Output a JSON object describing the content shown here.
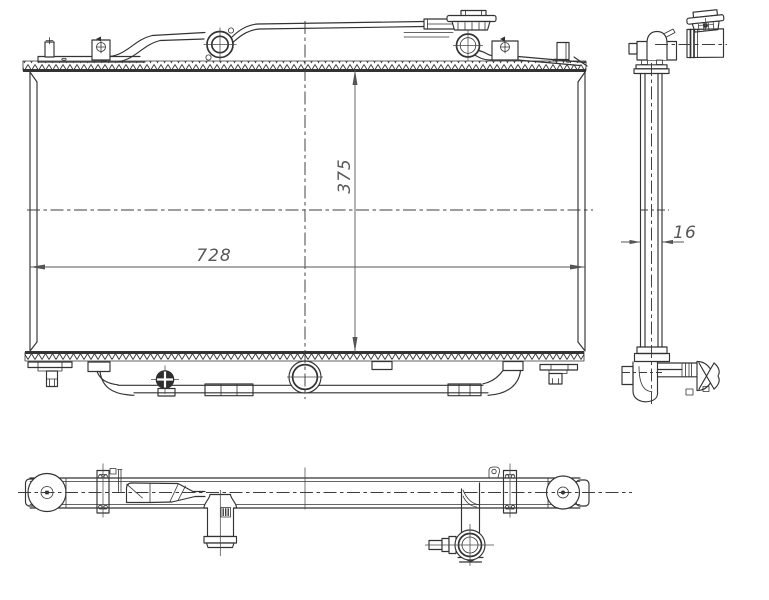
{
  "drawing": {
    "dimensions": {
      "width": "728",
      "height": "375",
      "thickness": "16"
    },
    "colors": {
      "background": "#ffffff",
      "line": "#333333",
      "dimension_text": "#575757"
    }
  }
}
